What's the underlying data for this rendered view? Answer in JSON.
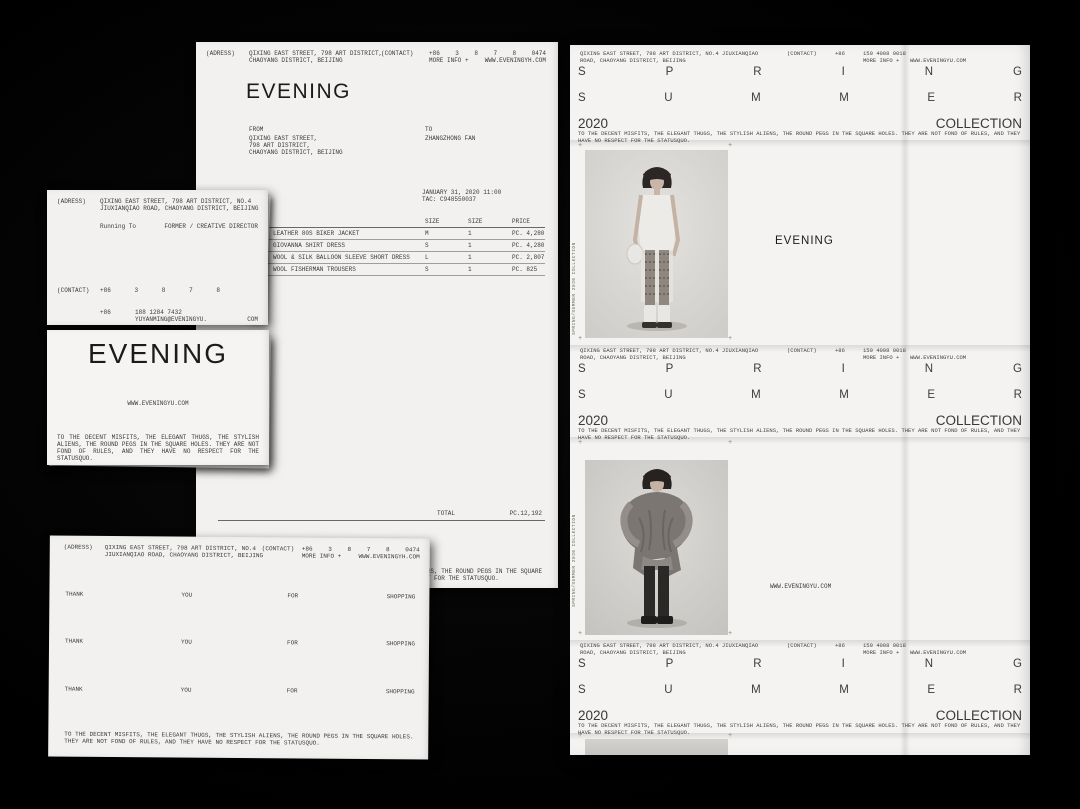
{
  "colors": {
    "background": "#000000",
    "paper": "#f2f1ef",
    "ink": "#3a3a3a"
  },
  "brand": {
    "logo": "EVENING"
  },
  "invoice": {
    "address_label": "(ADRESS)",
    "address_line1": "QIXING EAST STREET, 798 ART DISTRICT,",
    "address_line2": "CHAOYANG DISTRICT, BEIJING",
    "contact_label": "(CONTACT)",
    "phone_parts": [
      "+86",
      "3",
      "8",
      "7",
      "8",
      "0474"
    ],
    "more_info_label": "MORE INFO +",
    "website": "WWW.EVENINGYH.COM",
    "logo": "EVENING",
    "from_label": "FROM",
    "from_line1": "QIXING EAST STREET,",
    "from_line2": "798 ART DISTRICT,",
    "from_line3": "CHAOYANG DISTRICT, BEIJING",
    "to_label": "TO",
    "to_name": "ZHANGZHONG FAN",
    "datetime": "JANUARY 31, 2020 11:00",
    "tac": "TAC: C948550037",
    "col_size1": "SIZE",
    "col_size2": "SIZE",
    "col_price": "PRICE",
    "items": [
      {
        "name": "LEATHER 80S BIKER JACKET",
        "size": "M",
        "qty": "1",
        "price": "PC. 4,280"
      },
      {
        "name": "GIOVANNA SHIRT DRESS",
        "size": "S",
        "qty": "1",
        "price": "PC. 4,280"
      },
      {
        "name": "WOOL & SILK BALLOON SLEEVE SHORT DRESS",
        "size": "L",
        "qty": "1",
        "price": "PC. 2,807"
      },
      {
        "name": "WOOL FISHERMAN TROUSERS",
        "size": "S",
        "qty": "1",
        "price": "PC. 825"
      }
    ],
    "total_label": "TOTAL",
    "total_value": "PC.12,192",
    "slogan": "TO THE DECENT MISFITS, THE ELEGANT THUGS, THE STYLISH ALIENS, THE ROUND PEGS IN THE SQUARE HOLES. THEY ARE NOT FOND OF RULES, AND THEY HAVE NO RESPECT FOR THE STATUSQUO."
  },
  "business_card": {
    "address_label": "(ADRESS)",
    "address_line1": "QIXING EAST STREET, 798 ART DISTRICT, NO.4",
    "address_line2": "JIUXIANQIAO ROAD, CHAOYANG DISTRICT, BEIJING",
    "name": "Running  To",
    "title": "FORMER / CREATIVE DIRECTOR",
    "contact_label": "(CONTACT)",
    "phone_parts": [
      "+86",
      "3",
      "8",
      "7",
      "8"
    ],
    "mobile_prefix": "+86",
    "mobile": "188 1284 7432",
    "email": "YUYANMING@EVENINGYU.",
    "email_tld": "COM"
  },
  "logo_card": {
    "logo": "EVENING",
    "website": "WWW.EVENINGYU.COM",
    "slogan": "TO THE DECENT MISFITS, THE ELEGANT THUGS, THE STYLISH ALIENS, THE ROUND PEGS IN THE SQUARE HOLES. THEY ARE NOT FOND OF RULES, AND THEY HAVE NO RESPECT FOR THE STATUSQUO."
  },
  "receipt": {
    "address_label": "(ADRESS)",
    "address_line1": "QIXING EAST STREET, 798 ART DISTRICT, NO.4",
    "address_line2": "JIUXIANQIAO ROAD, CHAOYANG DISTRICT, BEIJING",
    "contact_label": "(CONTACT)",
    "phone_parts": [
      "+86",
      "3",
      "8",
      "7",
      "8",
      "0474"
    ],
    "more_info_label": "MORE INFO +",
    "website": "WWW.EVENINGYH.COM",
    "rows": [
      {
        "w1": "THANK",
        "w2": "YOU",
        "w3": "FOR",
        "w4": "SHOPPING"
      },
      {
        "w1": "THANK",
        "w2": "YOU",
        "w3": "FOR",
        "w4": "SHOPPING"
      },
      {
        "w1": "THANK",
        "w2": "YOU",
        "w3": "FOR",
        "w4": "SHOPPING"
      }
    ],
    "slogan": "TO THE DECENT MISFITS, THE ELEGANT THUGS, THE STYLISH ALIENS, THE ROUND PEGS IN THE SQUARE HOLES. THEY ARE NOT FOND OF RULES, AND THEY HAVE NO RESPECT FOR THE STATUSQUO."
  },
  "poster": {
    "header": {
      "address_line1": "QIXING EAST STREET, 798 ART DISTRICT, NO.4 JIUXIANQIAO",
      "address_line2": "ROAD, CHAOYANG DISTRICT, BEIJING",
      "contact_label": "(CONTACT)",
      "phone_prefix": "+86",
      "phone_number": "150 4008 0018",
      "more_info_label": "MORE INFO +",
      "website": "WWW.EVENINGYU.COM",
      "season_top": [
        "S",
        "P",
        "R",
        "I",
        "N",
        "G"
      ],
      "season_bottom": [
        "S",
        "U",
        "M",
        "M",
        "E",
        "R"
      ],
      "year": "2020",
      "collection_label": "COLLECTION",
      "slogan": "TO THE DECENT MISFITS, THE ELEGANT THUGS, THE STYLISH ALIENS, THE ROUND PEGS IN THE SQUARE HOLES. THEY ARE NOT FOND OF RULES, AND THEY HAVE NO RESPECT FOR THE STATUSQUO."
    },
    "panel1": {
      "side_label": "SPRING/SUMMER 2020 COLLECTION",
      "caption": "EVENING"
    },
    "panel2": {
      "side_label": "SPRING/SUMMER 2020 COLLECTION",
      "caption": "WWW.EVENINGYU.COM"
    }
  }
}
